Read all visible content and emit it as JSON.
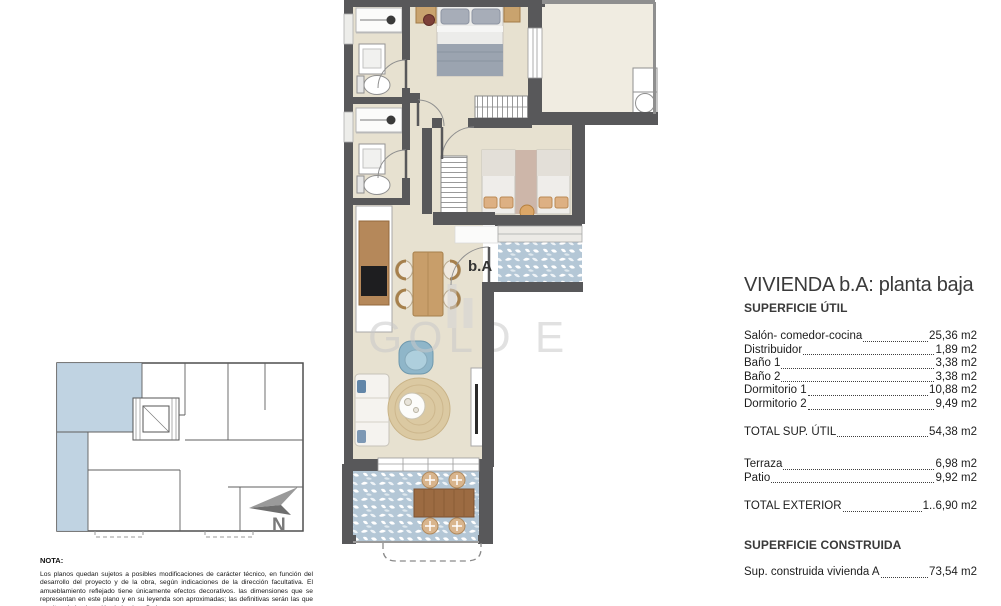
{
  "panel": {
    "title": "VIVIENDA b.A: planta baja",
    "superficie_util_title": "SUPERFICIE ÚTIL",
    "items": [
      {
        "label": "Salón- comedor-cocina",
        "value": "25,36 m2"
      },
      {
        "label": "Distribuidor",
        "value": "1,89 m2"
      },
      {
        "label": "Baño 1",
        "value": "3,38 m2"
      },
      {
        "label": "Baño 2",
        "value": "3,38 m2"
      },
      {
        "label": "Dormitorio 1",
        "value": "10,88 m2"
      },
      {
        "label": "Dormitorio 2",
        "value": "9,49 m2"
      }
    ],
    "total_util": {
      "label": "TOTAL SUP. ÚTIL",
      "value": "54,38 m2"
    },
    "exterior_items": [
      {
        "label": "Terraza",
        "value": "6,98 m2"
      },
      {
        "label": "Patio",
        "value": "9,92 m2"
      }
    ],
    "total_exterior": {
      "label": "TOTAL EXTERIOR",
      "value": "1..6,90 m2"
    },
    "superficie_construida_title": "SUPERFICIE CONSTRUIDA",
    "constructed": {
      "label": "Sup. construida vivienda A",
      "value": "73,54 m2"
    }
  },
  "plan": {
    "unit_label": "b.A"
  },
  "north_label": "N",
  "watermark": "GOLD E",
  "nota": {
    "heading": "NOTA:",
    "text": "Los planos quedan sujetos a posibles modificaciones de carácter técnico, en función del desarrollo del proyecto y de la obra, según indicaciones de la dirección facultativa. El amueblamiento reflejado tiene únicamente efectos decorativos. las dimensiones que se representan en este plano y en su leyenda son aproximadas; las definitivas serán las que resulten de la ejecución de la obra. Se hace"
  },
  "colors": {
    "wall": "#58585a",
    "floor_beige": "#e7e1d0",
    "patio_cream": "#f0ece1",
    "tile_blue": "#b4c7d6",
    "keyplan_highlight": "#bdd1e0"
  }
}
